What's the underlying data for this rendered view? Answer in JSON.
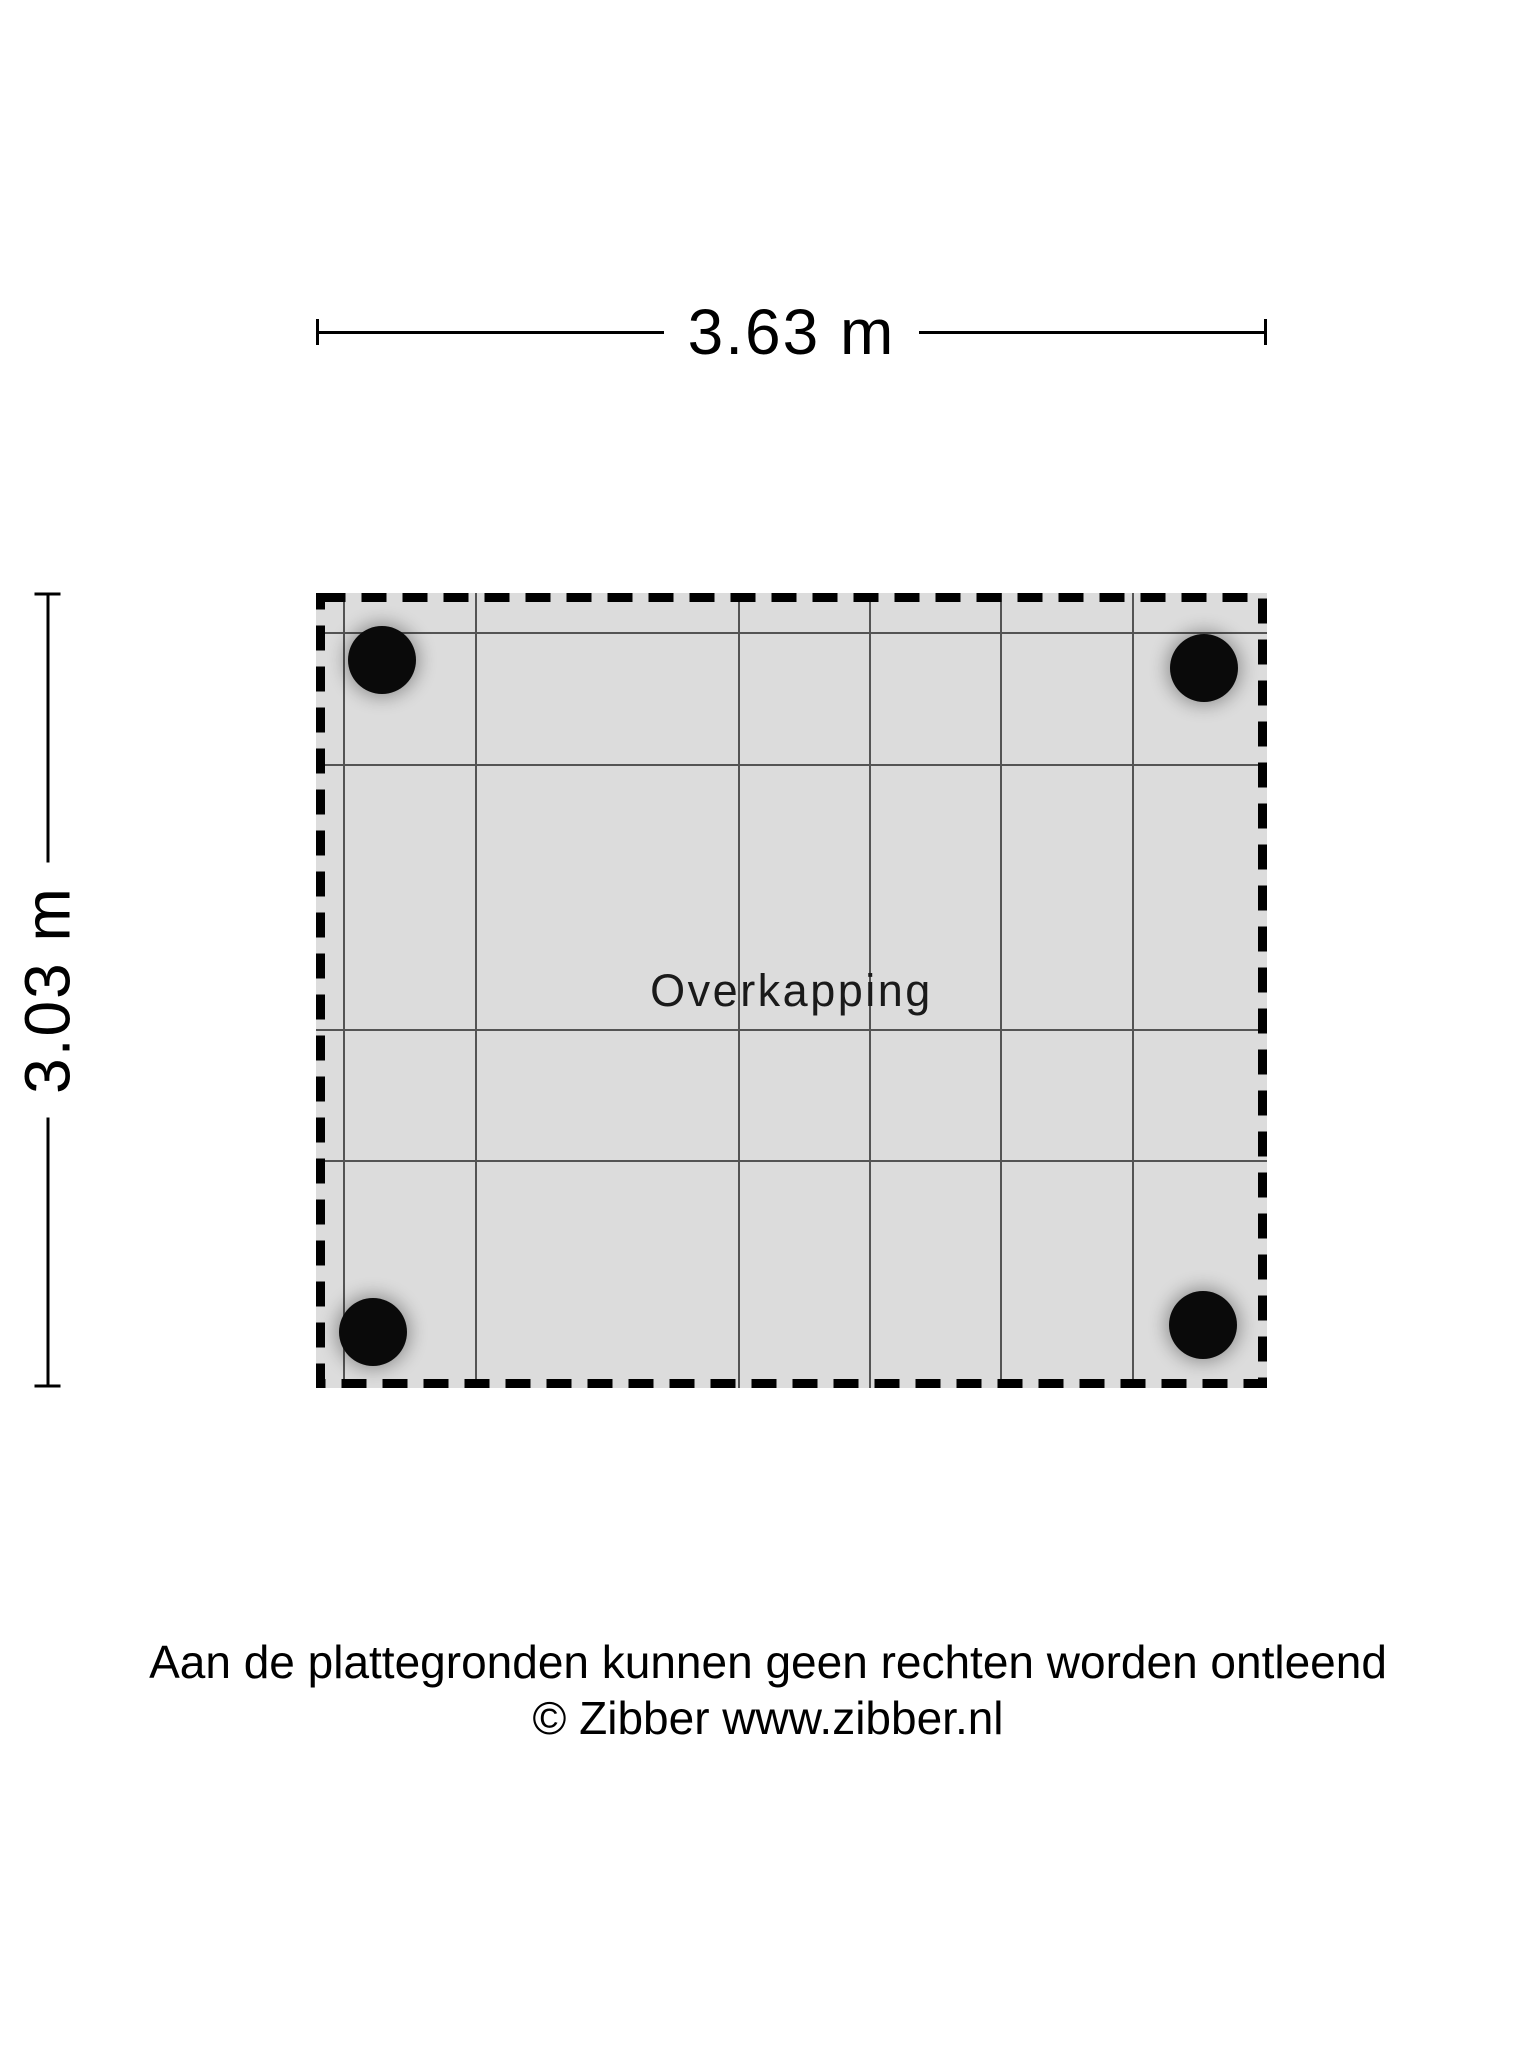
{
  "floorplan": {
    "room_label": "Overkapping",
    "width_label": "3.63 m",
    "height_label": "3.03 m",
    "posts_count": 4
  },
  "footer": {
    "disclaimer": "Aan de plattegronden kunnen geen rechten worden ontleend",
    "copyright": "© Zibber www.zibber.nl"
  },
  "colors": {
    "background": "#ffffff",
    "plan_fill": "#dcdcdc",
    "grid_line": "#545454",
    "dashed_border": "#000000",
    "post": "#0a0a0a",
    "text": "#000000"
  }
}
